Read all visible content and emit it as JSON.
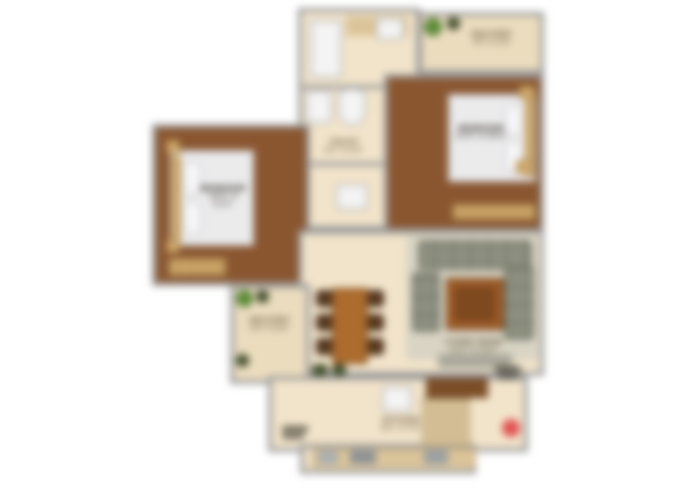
{
  "title": "2BHK apartment floor plan",
  "colors": {
    "wall": "#9a9a9a",
    "wood": "#8a5630",
    "tile": "#f2e4ca",
    "balcony": "#ebdcbe",
    "rug": "#d9d4c4",
    "sofa": "#8d9080",
    "coffee": "#a4602a",
    "coffee_inner": "#7e491f",
    "dining": "#ad6c2e",
    "chair": "#573921",
    "counter": "#dbc499",
    "cabinet": "#7c4e27",
    "bed": "#ebebec",
    "headboard": "#c8a262",
    "wardrobe": "#cfa869",
    "plant": "#5e8f38",
    "plant_dark": "#46532f",
    "fixture": "#f4f4f4",
    "marker": "#e15252",
    "label": "#5a4a33",
    "bed_label": "#3a322a"
  },
  "rooms": {
    "bath": {
      "label": "TOILET",
      "dims": "5'0\" X 4'0\""
    },
    "balcony_top": {
      "label": "BALCONY",
      "dims": "7'6\" X 3'6\""
    },
    "bedroom_right": {
      "label": "BEDROOM",
      "dims": "11'0\" X 10'0\""
    },
    "bedroom_left": {
      "label": "BEDROOM",
      "dims": "10'6\" X 11'0\""
    },
    "living": {
      "label": "LIVING ROOM",
      "dims": "12'0\" X 10'6\""
    },
    "balcony_bottom": {
      "label": "BALCONY",
      "dims": "4'0\" X 6'6\""
    },
    "kitchen": {
      "label": "KITCHEN",
      "dims": "8'0\" X 7'0\""
    }
  },
  "furniture_icons": [
    "shower-icon",
    "washbasin-icon",
    "toilet-icon",
    "washing-machine-icon",
    "double-bed-icon",
    "nightstand-icon",
    "wardrobe-icon",
    "dining-table-icon",
    "dining-chair-icon",
    "sectional-sofa-icon",
    "coffee-table-icon",
    "tv-unit-icon",
    "rug-icon",
    "kitchen-counter-icon",
    "sink-icon",
    "stove-icon",
    "plant-icon",
    "entry-marker-icon"
  ],
  "marker": {
    "name": "entry-marker",
    "color": "#e15252"
  }
}
